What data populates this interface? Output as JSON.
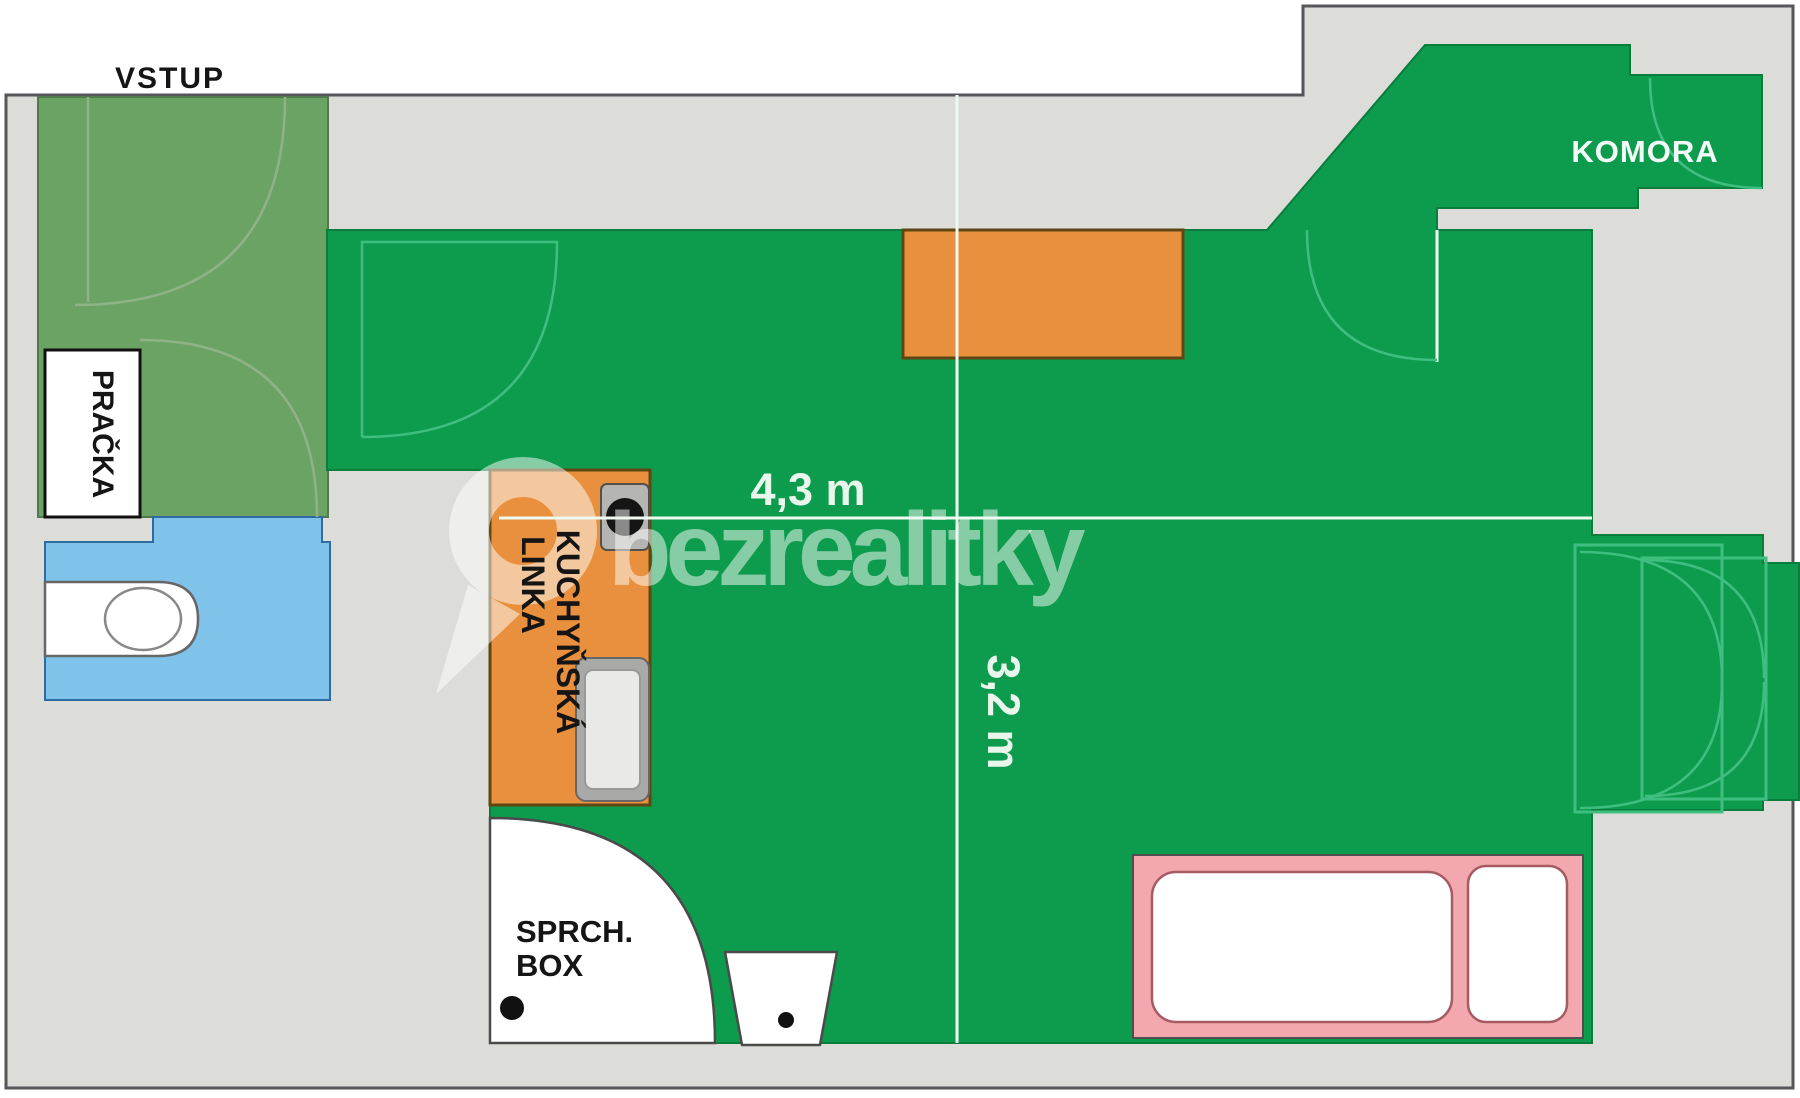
{
  "type": "floor_plan",
  "plan": {
    "entrance_label": "VSTUP",
    "washer_label": "PRAČKA",
    "storage_label": "KOMORA",
    "kitchen_label_line1": "KUCHYŇSKÁ",
    "kitchen_label_line2": "LINKA",
    "shower_label_line1": "SPRCH.",
    "shower_label_line2": "BOX",
    "dim_horizontal": "4,3 m",
    "dim_vertical": "3,2 m"
  },
  "watermark": {
    "brand": "bezrealitky"
  },
  "colors": {
    "main_room_green": "#0d9b4d",
    "entry_green": "#6ba365",
    "wc_blue": "#80c3ea",
    "furniture_orange": "#e8903d",
    "bed_pink": "#f3a8af",
    "wall_grey": "#dcdcd9",
    "outline_dark": "#55565a",
    "door_arc_green": "#3fbf7f",
    "dimension_text": "#e9f6ec"
  }
}
